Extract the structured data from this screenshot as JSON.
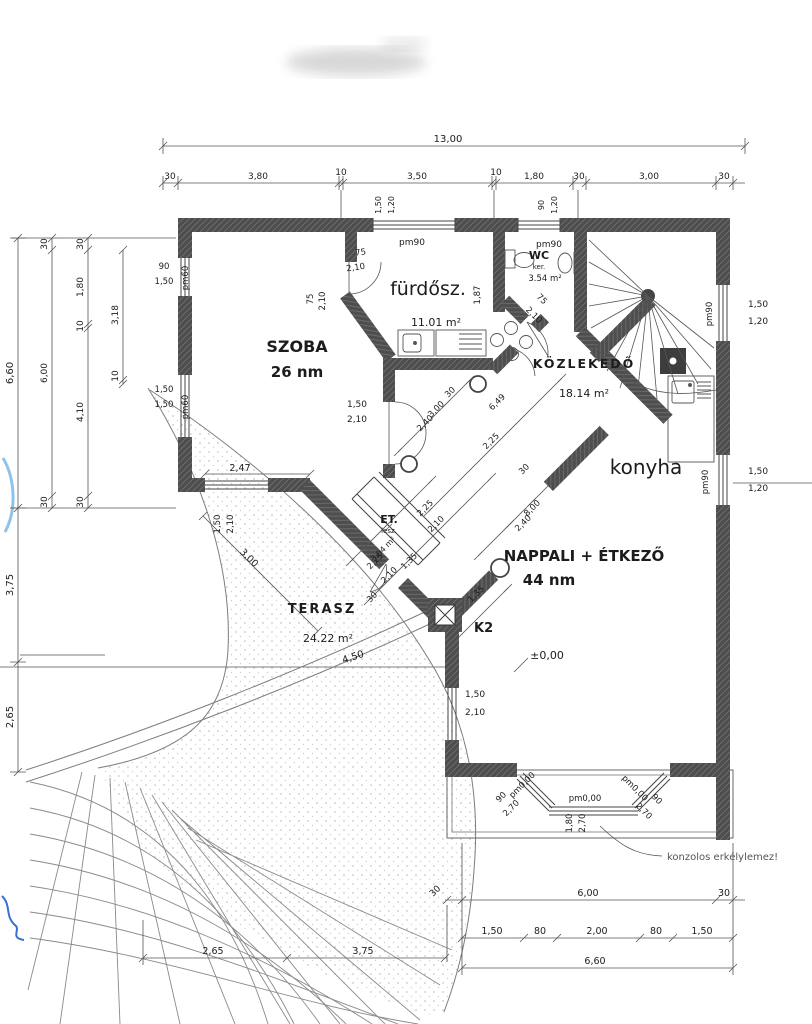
{
  "rooms": {
    "szoba": {
      "name": "SZOBA",
      "area": "26 nm"
    },
    "furdo": {
      "name": "fürdősz.",
      "area": "11.01 m²"
    },
    "wc": {
      "name": "WC",
      "sub": "ker.",
      "area": "3.54 m²"
    },
    "kozlekedo": {
      "name": "KÖZLEKEDŐ",
      "area": "18.14 m²"
    },
    "konyha": {
      "name": "konyha"
    },
    "nappali": {
      "name": "NAPPALI + ÉTKEZŐ",
      "area": "44 nm"
    },
    "terasz": {
      "name": "TERASZ",
      "area": "24.22 m²"
    },
    "et": {
      "name": "ET.",
      "sub": "lesz.",
      "area": "3,04 m²"
    }
  },
  "markers": {
    "k2": "K2",
    "level": "±0,00",
    "note": "konzolos erkélylemez!"
  },
  "opening_labels": {
    "pm90": "pm90",
    "pm60": "pm60",
    "pm000": "pm0,00"
  },
  "colors": {
    "wall": "#4e4e4e",
    "line": "#555555",
    "blue_mark": "#5b8fd6"
  },
  "dims": {
    "top": {
      "total": "13,00",
      "c": [
        "30",
        "3,80",
        "10",
        "3,50",
        "10",
        "1,80",
        "30",
        "3,00",
        "30"
      ],
      "winA": [
        "1,50",
        "1,20"
      ],
      "winB": [
        "90",
        "1,20"
      ]
    },
    "left": {
      "total": "6,60",
      "a": [
        "30",
        "6,00",
        "30"
      ],
      "b": [
        "30",
        "1,80",
        "10",
        "4,10",
        "30"
      ],
      "cc": [
        "3,18",
        "10"
      ],
      "lower": [
        "3,75",
        "2,65"
      ],
      "win1": [
        "90",
        "1,50"
      ],
      "win2": [
        "1,50",
        "1,50"
      ]
    },
    "right": {
      "win1": [
        "1,50",
        "1,20"
      ],
      "win2": [
        "1,50",
        "1,20"
      ]
    },
    "bottom": {
      "a": [
        "30",
        "6,00",
        "30"
      ],
      "b": [
        "1,50",
        "80",
        "2,00",
        "80",
        "1,50"
      ],
      "total": "6,60",
      "leftchain": [
        "2,65",
        "3,75"
      ],
      "bayL": [
        "90",
        "2,70"
      ],
      "bayC": [
        "1,80",
        "2,70"
      ],
      "bayR": [
        "2,70",
        "90"
      ]
    },
    "interior": {
      "szoba_door": [
        "1,50",
        "2,10"
      ],
      "szoba_win": "2,47",
      "szoba_win_v": [
        "1,50",
        "2,10"
      ],
      "terasz_diag": "3,00",
      "curve": "4,50",
      "bath_door": [
        "75",
        "2,10"
      ],
      "bath_door2": [
        "75",
        "2,10"
      ],
      "wc_door": [
        "75",
        "2,10"
      ],
      "bath_depth": "1,87",
      "hallA": [
        "30",
        "3,00",
        "2,40"
      ],
      "hallB": "6,49",
      "hallC": "2,25",
      "hallD": [
        "30",
        "8,00",
        "2,40"
      ],
      "et": [
        "2,25",
        "2,10",
        "1,35",
        "2,25",
        "2,10",
        "30",
        "1,35"
      ],
      "west_win": [
        "1,50",
        "2,10"
      ]
    }
  }
}
